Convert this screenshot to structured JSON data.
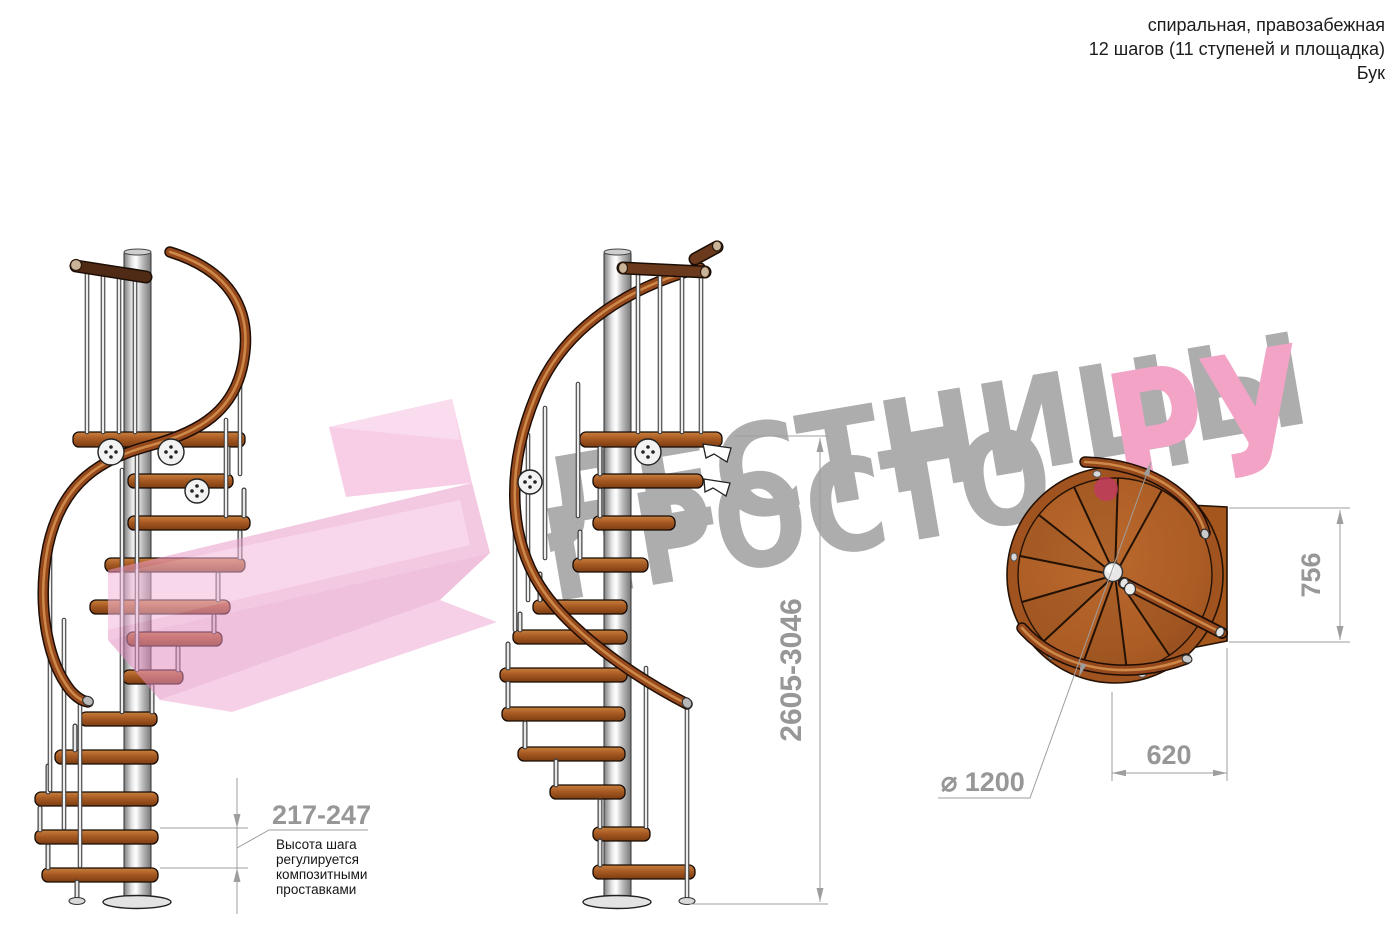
{
  "header": {
    "line1": "спиральная, правозабежная",
    "line2": "12 шагов (11 ступеней и площадка)",
    "line3": "Бук"
  },
  "watermark": {
    "word1": "ЛЕСТНИЦЫ",
    "word2": "ПРОСТО",
    "word3": "РУ",
    "gray": "#a7a7a7",
    "pink": "#f19cc2",
    "dot_color": "#c23a62"
  },
  "logo_arrow": {
    "color": "#ec8fc8"
  },
  "dims": {
    "total_height": "2605-3046",
    "step_height": "217-247",
    "plan_depth": "756",
    "plan_width": "620",
    "diameter": "⌀ 1200"
  },
  "note": {
    "l1": "Высота шага",
    "l2": "регулируется",
    "l3": "композитными",
    "l4": "проставками"
  },
  "materials": {
    "wood": "#a3541e",
    "wood_dark": "#6f3310",
    "rail": "#96491c",
    "metal_pole": "#d9d9d9",
    "dim_gray": "#979797"
  }
}
